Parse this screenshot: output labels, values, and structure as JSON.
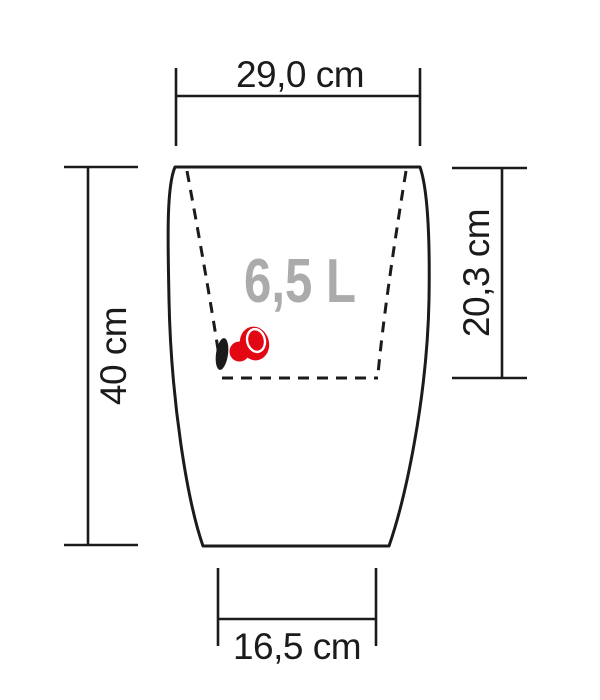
{
  "diagram": {
    "dimensions": {
      "top_width": "29,0 cm",
      "height": "40 cm",
      "inner_depth": "20,3 cm",
      "base_width": "16,5 cm"
    },
    "volume_label": "6,5 L",
    "colors": {
      "line": "#1b1b1b",
      "volume_text": "#ababab",
      "accent_red": "#e30613",
      "background": "#ffffff"
    },
    "icons": [
      {
        "name": "water-level-indicator-icon",
        "color": "#e30613"
      },
      {
        "name": "drainage-slot-icon",
        "color": "#1b1b1b"
      }
    ]
  }
}
